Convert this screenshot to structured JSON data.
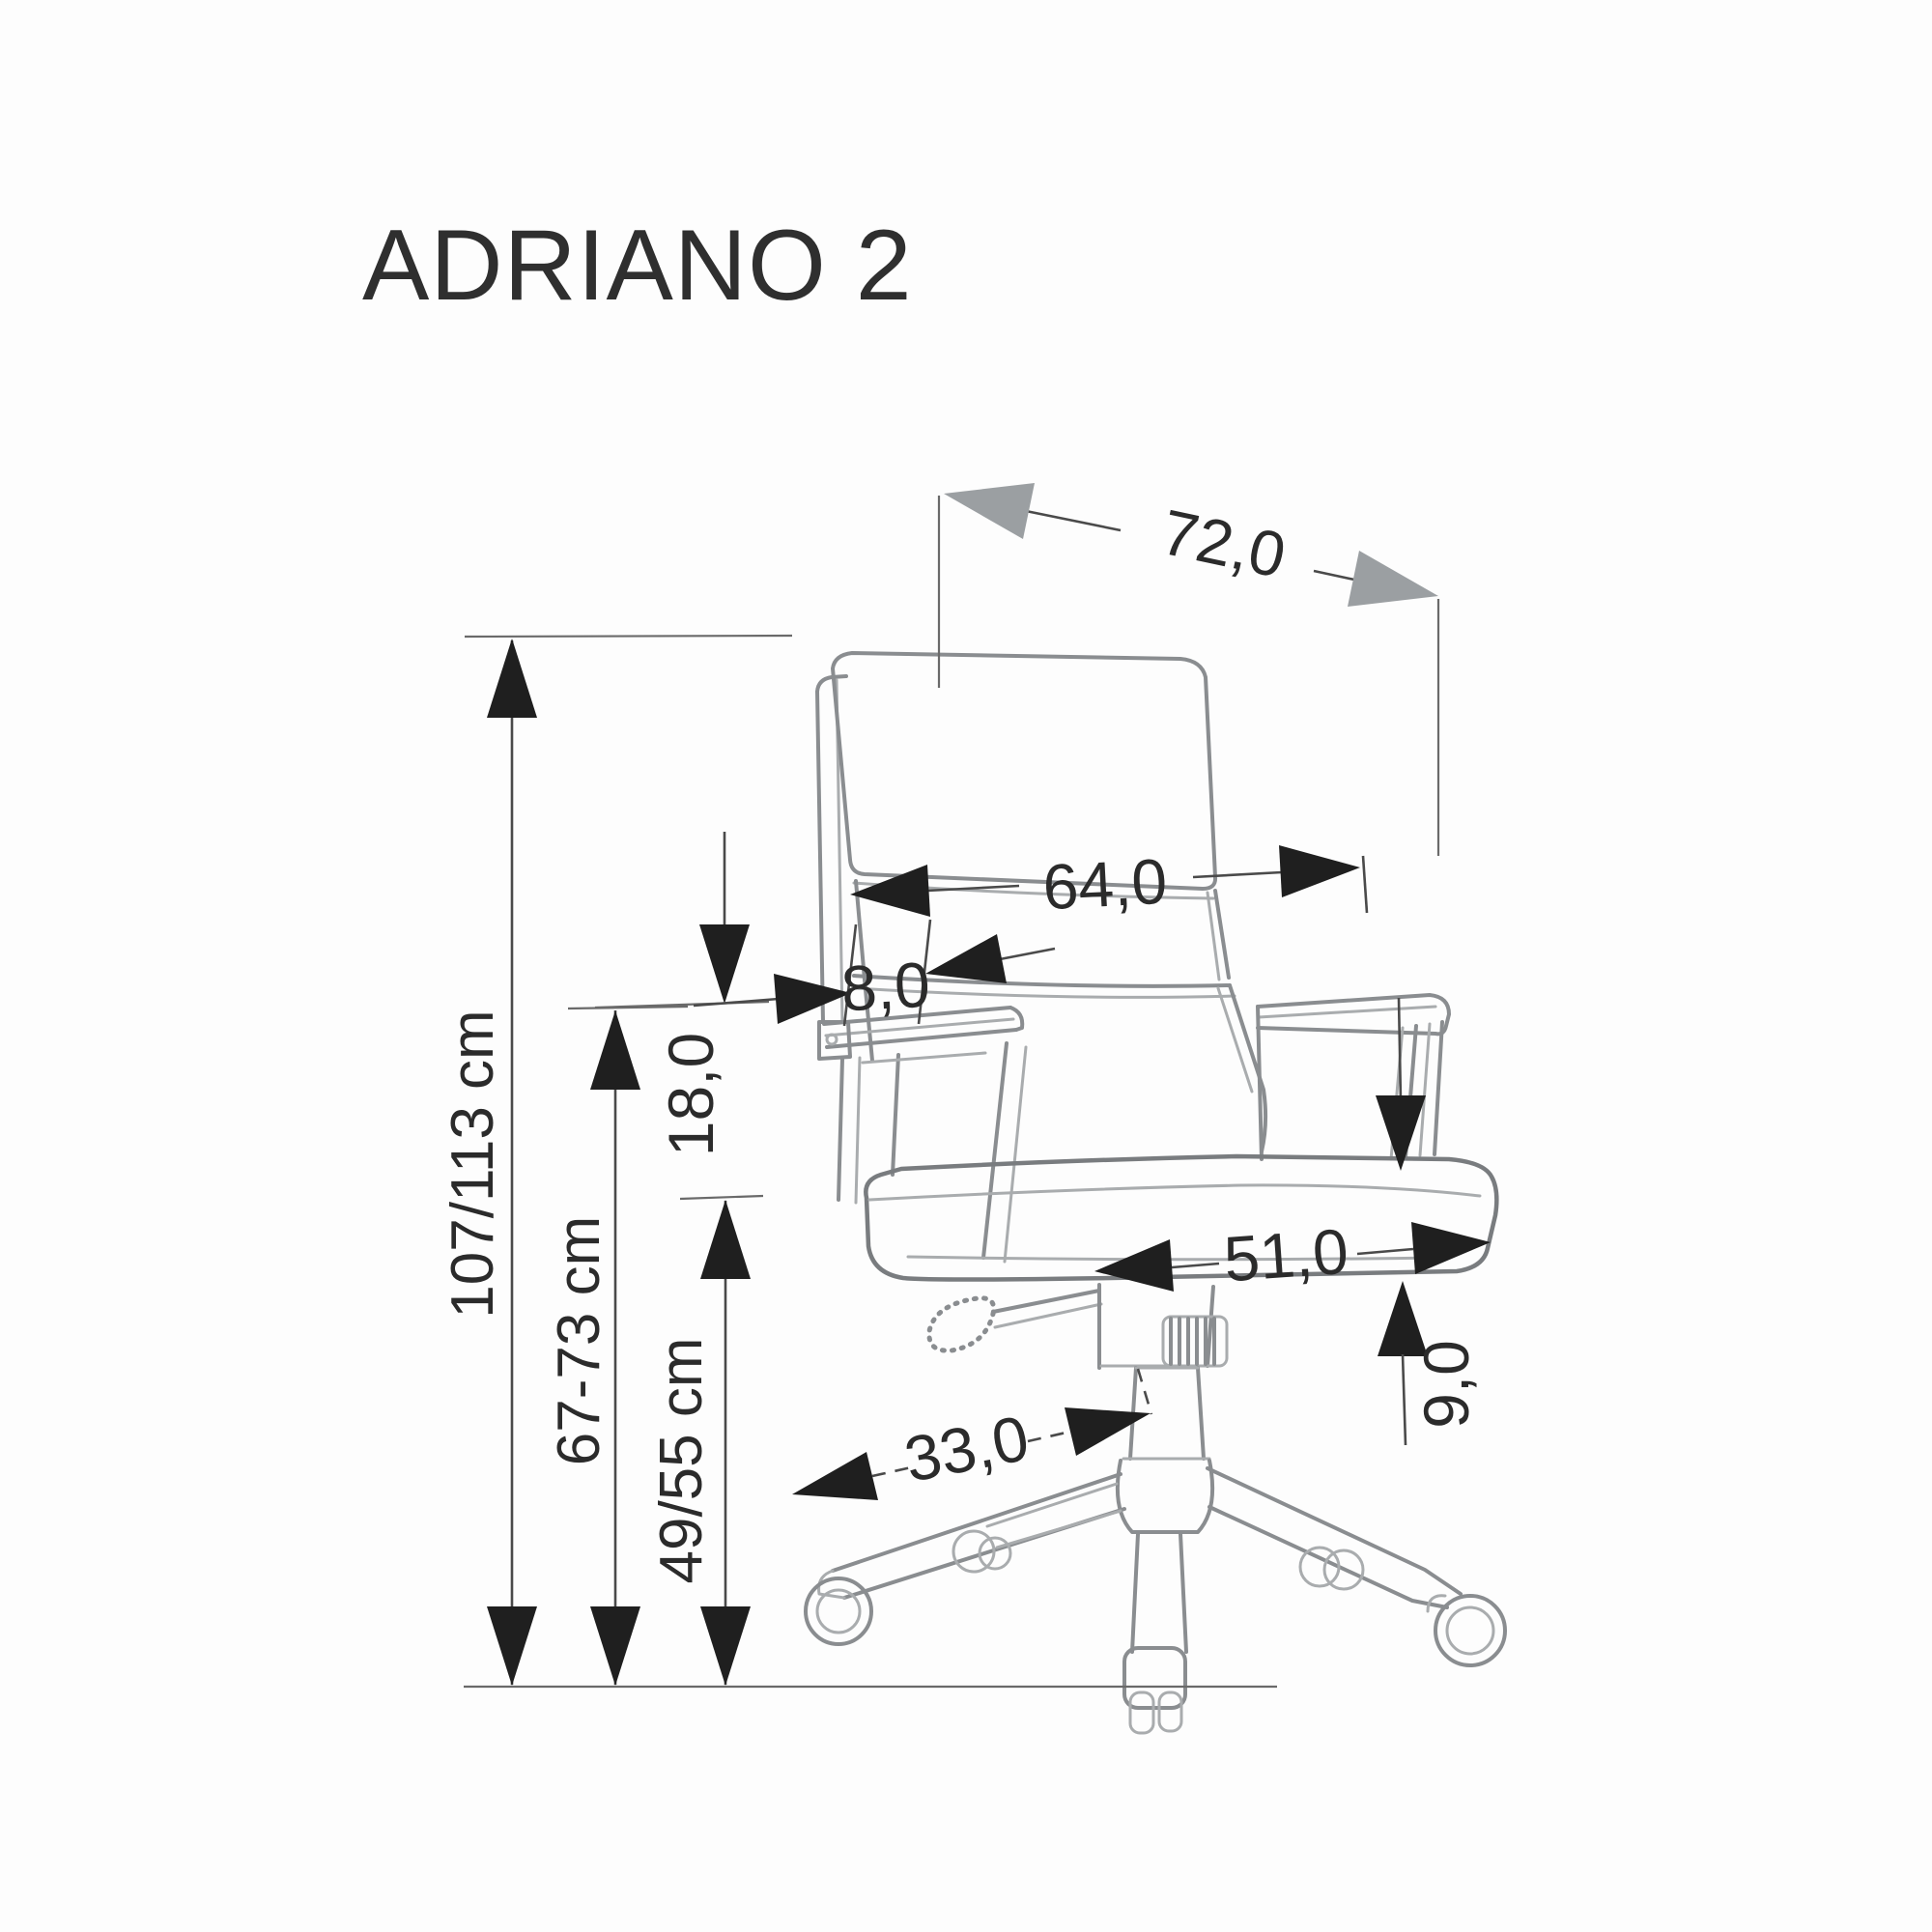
{
  "title": "ADRIANO 2",
  "drawing_type": "office chair dimension diagram",
  "dimensions": {
    "depth_top": "72,0",
    "backrest_width": "64,0",
    "backrest_thickness": "8,0",
    "armrest_gap": "18,0",
    "total_height": "107/113 cm",
    "armrest_height": "67-73 cm",
    "seat_height": "49/55 cm",
    "seat_depth": "51,0",
    "seat_thickness": "9,0",
    "base_arm_length": "33,0"
  },
  "units_note": "cm",
  "colors": {
    "background": "#fdfdfd",
    "line_art": "#8a8d90",
    "dimension_lines": "#4a4a4a",
    "arrows_black": "#1f1f1f",
    "arrows_gray": "#9b9fa2",
    "text": "#2b2b2b"
  }
}
